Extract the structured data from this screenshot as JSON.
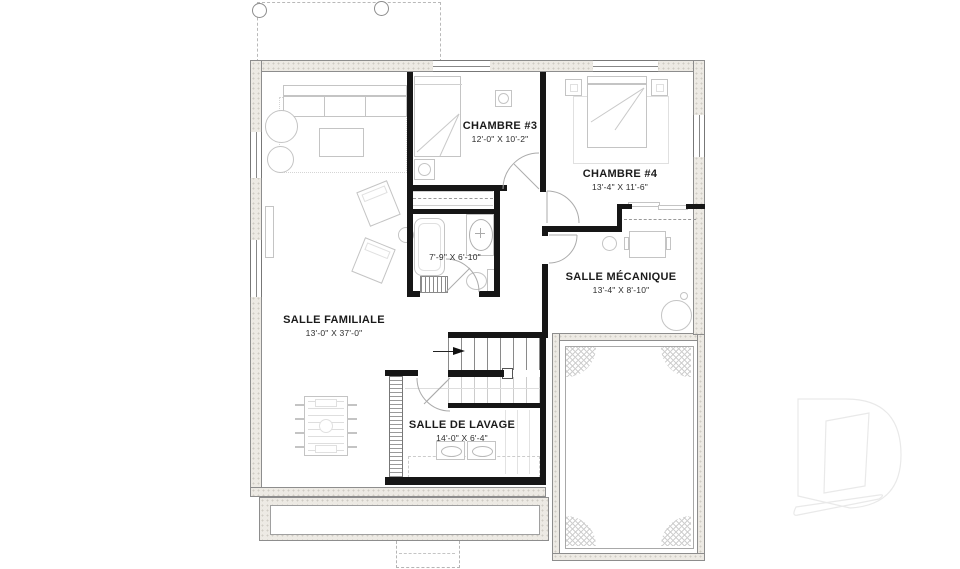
{
  "plan": {
    "title": "Basement floor plan",
    "rooms": {
      "chambre3": {
        "name": "CHAMBRE #3",
        "dims": "12'-0\" X 10'-2\""
      },
      "chambre4": {
        "name": "CHAMBRE #4",
        "dims": "13'-4\" X 11'-6\""
      },
      "mecanique": {
        "name": "SALLE MÉCANIQUE",
        "dims": "13'-4\" X 8'-10\""
      },
      "familiale": {
        "name": "SALLE FAMILIALE",
        "dims": "13'-0\" X 37'-0\""
      },
      "lavage": {
        "name": "SALLE DE LAVAGE",
        "dims": "14'-0\" X 6'-4\""
      },
      "bain": {
        "dims": "7'-9\" X 6'-10\""
      }
    },
    "watermark_letter": "D",
    "colors": {
      "interior_wall": "#161616",
      "foundation_fill": "#edeae4",
      "foundation_line": "#8d8d8d",
      "furniture_line": "#c4c4c4",
      "watermark": "#e9e9e9"
    }
  }
}
